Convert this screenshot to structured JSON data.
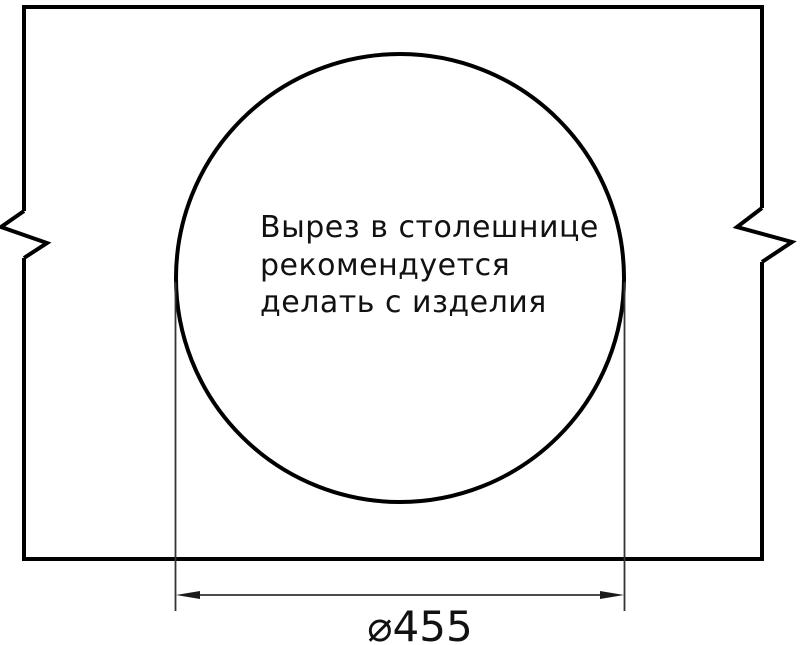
{
  "drawing": {
    "annotation": {
      "lines": [
        "Вырез в столешнице",
        "рекомендуется",
        "делать с изделия"
      ]
    },
    "dimension": {
      "label": "⌀455",
      "value": 455,
      "symbol": "diameter"
    },
    "colors": {
      "outline": "#000000",
      "thin_line": "#333333",
      "text": "#111111",
      "background": "#ffffff"
    }
  }
}
